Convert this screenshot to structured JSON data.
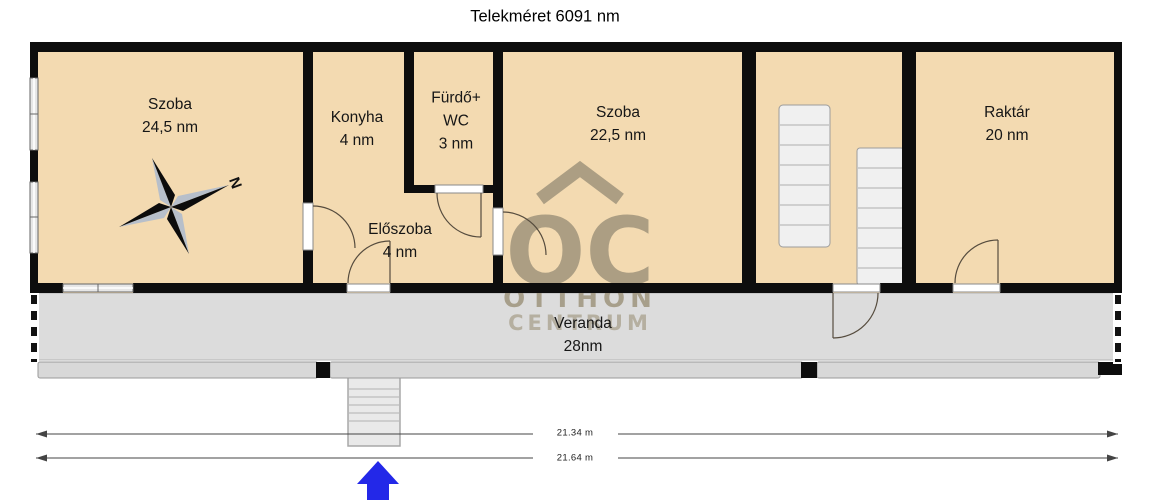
{
  "title": "Telekméret 6091 nm",
  "compass": {
    "north_label": "N"
  },
  "rooms": [
    {
      "id": "szoba-1",
      "line1": "Szoba",
      "line2": "24,5 nm"
    },
    {
      "id": "konyha",
      "line1": "Konyha",
      "line2": "4 nm"
    },
    {
      "id": "furdo-wc",
      "line1": "Fürdő+",
      "line2": "WC",
      "line3": "3 nm"
    },
    {
      "id": "szoba-2",
      "line1": "Szoba",
      "line2": "22,5 nm"
    },
    {
      "id": "raktar",
      "line1": "Raktár",
      "line2": "20 nm"
    },
    {
      "id": "eloszoba",
      "line1": "Előszoba",
      "line2": "4 nm"
    },
    {
      "id": "veranda",
      "line1": "Veranda",
      "line2": "28nm"
    }
  ],
  "dimensions": {
    "inner": "21.34 m",
    "outer": "21.64 m"
  },
  "watermark": {
    "logo": "OC",
    "line1": "OTTHON",
    "line2": "CENTRUM"
  },
  "colors": {
    "floor": "#f3dab1",
    "wall": "#0d0d0d",
    "veranda_floor": "#dcdcdc",
    "watermark": "#9b9078",
    "entrance_arrow": "#2328e8"
  }
}
